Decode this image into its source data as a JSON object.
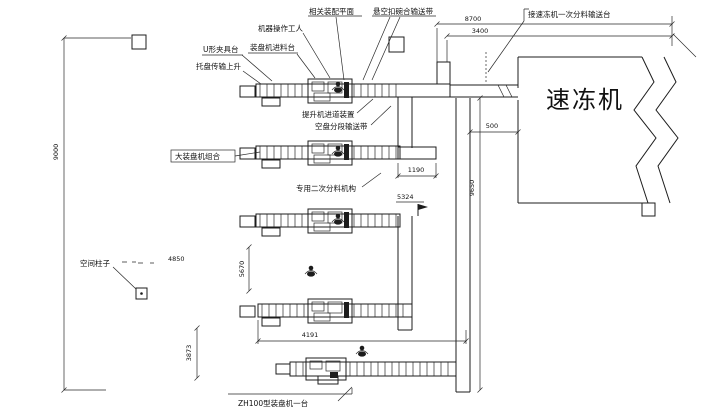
{
  "freezer": {
    "label": "速冻机"
  },
  "labels": {
    "assembly_plane": "相关装配平面",
    "hanging_belt": "悬空扣碗合输送带",
    "worker": "机器操作工人",
    "u_fixture": "U形夹具台",
    "infeed_table": "装盘机进料台",
    "tray_lift": "托盘传输上升",
    "lift_entry": "提升机进道装置",
    "empty_tray_belt": "空盘分段输送带",
    "main_unit": "大装盘机组合",
    "secondary_feed": "专用二次分料机构",
    "freezer_infeed": "接速冻机一次分料输送台",
    "column": "空间柱子",
    "zh100": "ZH100型装盘机一台"
  },
  "dimensions": {
    "top_overall": "8700",
    "top_inner": "3400",
    "left_height": "9000",
    "freezer_gap": "500",
    "main_conveyor": "9650",
    "row2_out": "1190",
    "elevation": "5324",
    "row4_width": "4191",
    "col_offset": "4850",
    "row_gap": "5670",
    "bottom_height": "3873"
  }
}
